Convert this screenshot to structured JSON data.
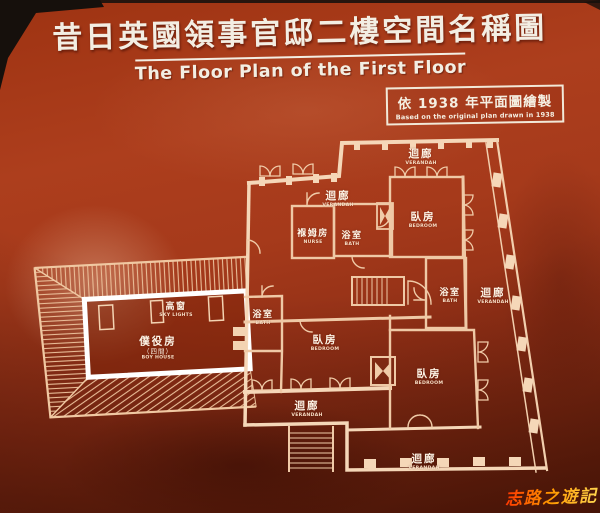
{
  "header": {
    "title_zh": "昔日英國領事官邸二樓空間名稱圖",
    "title_en": "The Floor Plan of the First Floor"
  },
  "badge": {
    "zh": "依 1938 年平面圖繪製",
    "en": "Based on the original plan drawn in 1938"
  },
  "plan": {
    "labels": [
      {
        "id": "verandah-top-right",
        "zh": "迴廊",
        "en": "VERANDAH"
      },
      {
        "id": "verandah-top",
        "zh": "迴廊",
        "en": "VERANDAH"
      },
      {
        "id": "bedroom-upper-right",
        "zh": "臥房",
        "en": "BEDROOM"
      },
      {
        "id": "nurse-room",
        "zh": "褓姆房",
        "en": "NURSE"
      },
      {
        "id": "bath-upper",
        "zh": "浴室",
        "en": "BATH"
      },
      {
        "id": "bath-right",
        "zh": "浴室",
        "en": "BATH"
      },
      {
        "id": "verandah-right",
        "zh": "迴廊",
        "en": "VERANDAH"
      },
      {
        "id": "skylights",
        "zh": "高窗",
        "en": "SKY LIGHTS"
      },
      {
        "id": "servants-room",
        "zh": "僕役房",
        "sub": "（四間）",
        "en": "BOY HOUSE"
      },
      {
        "id": "bath-left",
        "zh": "浴室",
        "en": "BATH"
      },
      {
        "id": "bedroom-center",
        "zh": "臥房",
        "en": "BEDROOM"
      },
      {
        "id": "bedroom-lower-right",
        "zh": "臥房",
        "en": "BEDROOM"
      },
      {
        "id": "verandah-bottom-left",
        "zh": "迴廊",
        "en": "VERANDAH"
      },
      {
        "id": "verandah-bottom",
        "zh": "迴廊",
        "en": "VERANDAH"
      }
    ]
  },
  "watermark": {
    "text": "志路之遊記"
  },
  "colors": {
    "board_red": "#a63a1b",
    "plan_line": "#f2cba8",
    "wall_bright": "#f5d7b8",
    "text_cream": "#f3eee3",
    "watermark_orange": "#ff9a00",
    "photo_edge_black": "#16100c"
  }
}
